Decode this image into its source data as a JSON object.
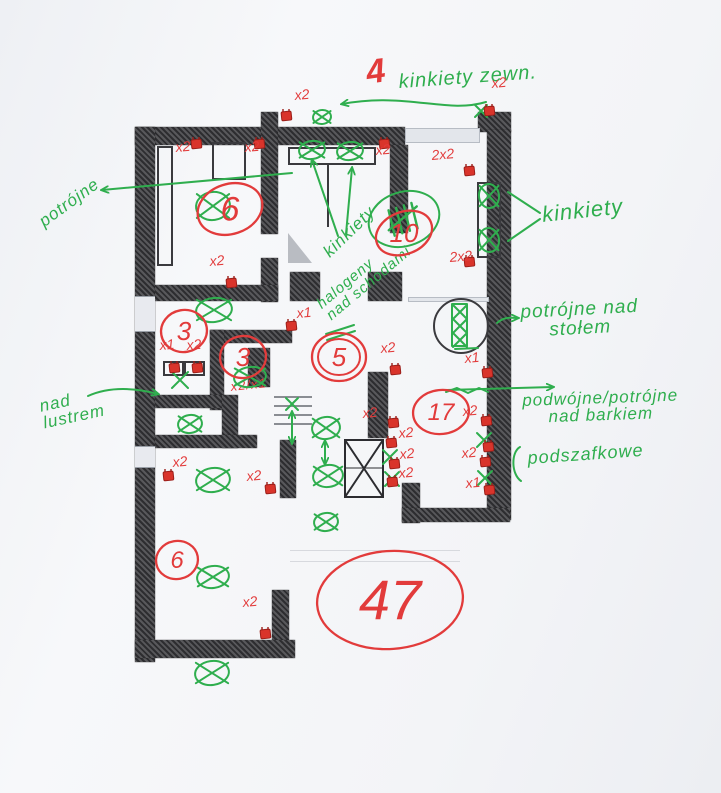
{
  "page": {
    "kind": "scanned hand-annotated electrical floor plan",
    "language": "pl"
  },
  "colors": {
    "green": "#2fae4e",
    "red": "#e23b3b",
    "wall": "#3c3c40",
    "paper": "#f5f6f8"
  },
  "labels": [
    {
      "name": "count-4-exterior",
      "lines": [
        "4"
      ],
      "color": "red",
      "x": 364,
      "y": 56,
      "size": 34,
      "rot": -8,
      "bold": true
    },
    {
      "name": "kinkiety-zewn-label",
      "lines": [
        "kinkiety zewn."
      ],
      "color": "green",
      "x": 398,
      "y": 72,
      "size": 20,
      "rot": -4
    },
    {
      "name": "potrojne-label",
      "lines": [
        "potrójne"
      ],
      "color": "green",
      "x": 36,
      "y": 216,
      "size": 17,
      "rot": -36
    },
    {
      "name": "kinkiety-mid-label",
      "lines": [
        "kinkiety"
      ],
      "color": "green",
      "x": 320,
      "y": 248,
      "size": 17,
      "rot": -44
    },
    {
      "name": "kinkiety-right-label",
      "lines": [
        "kinkiety"
      ],
      "color": "green",
      "x": 541,
      "y": 204,
      "size": 22,
      "rot": -6
    },
    {
      "name": "nad-lustrem-label",
      "lines": [
        "nad",
        "lustrem"
      ],
      "color": "green",
      "x": 38,
      "y": 398,
      "size": 17,
      "rot": -12
    },
    {
      "name": "halogeny-label",
      "lines": [
        "halogeny",
        "nad schodami"
      ],
      "color": "green",
      "x": 314,
      "y": 300,
      "size": 15,
      "rot": -40
    },
    {
      "name": "nad-stolem-label",
      "lines": [
        "potrójne nad",
        "stołem"
      ],
      "color": "green",
      "x": 520,
      "y": 303,
      "size": 19,
      "rot": -3,
      "center": true
    },
    {
      "name": "nad-barkiem-label",
      "lines": [
        "podwójne/potrójne",
        "nad barkiem"
      ],
      "color": "green",
      "x": 522,
      "y": 392,
      "size": 17,
      "rot": -2,
      "center": true
    },
    {
      "name": "podszafkowe-label",
      "lines": [
        "podszafkowe"
      ],
      "color": "green",
      "x": 527,
      "y": 449,
      "size": 18,
      "rot": -4
    },
    {
      "name": "socket-note-x2x1",
      "lines": [
        "x2/x1"
      ],
      "color": "red",
      "x": 230,
      "y": 380,
      "size": 13,
      "rot": -6
    }
  ],
  "counts": [
    {
      "value": "6",
      "cx": 230,
      "cy": 209,
      "rx": 33,
      "ry": 25,
      "rot": -18,
      "size": 34
    },
    {
      "value": "10",
      "cx": 404,
      "cy": 233,
      "rx": 29,
      "ry": 21,
      "rot": -22,
      "size": 26
    },
    {
      "value": "3",
      "cx": 184,
      "cy": 331,
      "rx": 23,
      "ry": 21,
      "rot": -10,
      "size": 26
    },
    {
      "value": "3",
      "cx": 243,
      "cy": 357,
      "rx": 23,
      "ry": 21,
      "rot": -8,
      "size": 26
    },
    {
      "value": "5",
      "cx": 339,
      "cy": 357,
      "rx": 27,
      "ry": 24,
      "rot": 0,
      "size": 26,
      "double": true
    },
    {
      "value": "17",
      "cx": 441,
      "cy": 412,
      "rx": 28,
      "ry": 22,
      "rot": -6,
      "size": 24
    },
    {
      "value": "6",
      "cx": 177,
      "cy": 560,
      "rx": 21,
      "ry": 19,
      "rot": -10,
      "size": 24
    },
    {
      "value": "47",
      "cx": 390,
      "cy": 600,
      "rx": 73,
      "ry": 49,
      "rot": -4,
      "size": 56
    }
  ],
  "tally": {
    "cx": 404,
    "cy": 219,
    "rx": 36,
    "ry": 27,
    "rot": -18,
    "marks": 5
  },
  "lamps": [
    {
      "cx": 322,
      "cy": 117,
      "rx": 9,
      "ry": 7
    },
    {
      "cx": 312,
      "cy": 150,
      "rx": 13,
      "ry": 9
    },
    {
      "cx": 350,
      "cy": 151,
      "rx": 13,
      "ry": 9
    },
    {
      "cx": 214,
      "cy": 310,
      "rx": 18,
      "ry": 12
    },
    {
      "cx": 489,
      "cy": 196,
      "rx": 10,
      "ry": 12
    },
    {
      "cx": 489,
      "cy": 240,
      "rx": 10,
      "ry": 12
    },
    {
      "cx": 250,
      "cy": 377,
      "rx": 16,
      "ry": 10
    },
    {
      "cx": 190,
      "cy": 424,
      "rx": 12,
      "ry": 9
    },
    {
      "cx": 213,
      "cy": 480,
      "rx": 17,
      "ry": 12
    },
    {
      "cx": 326,
      "cy": 428,
      "rx": 14,
      "ry": 11
    },
    {
      "cx": 328,
      "cy": 476,
      "rx": 15,
      "ry": 11
    },
    {
      "cx": 326,
      "cy": 522,
      "rx": 12,
      "ry": 9
    },
    {
      "cx": 213,
      "cy": 577,
      "rx": 16,
      "ry": 11
    },
    {
      "cx": 212,
      "cy": 673,
      "rx": 17,
      "ry": 12
    },
    {
      "cx": 213,
      "cy": 206,
      "rx": 17,
      "ry": 14
    }
  ],
  "x_marks": [
    {
      "x": 180,
      "y": 380,
      "s": 8
    },
    {
      "x": 390,
      "y": 457,
      "s": 7
    },
    {
      "x": 392,
      "y": 479,
      "s": 7
    },
    {
      "x": 484,
      "y": 440,
      "s": 7
    },
    {
      "x": 485,
      "y": 478,
      "s": 7
    },
    {
      "x": 460,
      "y": 312,
      "s": 7
    },
    {
      "x": 460,
      "y": 326,
      "s": 7
    },
    {
      "x": 460,
      "y": 340,
      "s": 7
    },
    {
      "x": 292,
      "y": 404,
      "s": 6
    },
    {
      "x": 481,
      "y": 111,
      "s": 6
    }
  ],
  "sockets": [
    {
      "x": 281,
      "y": 112,
      "label": "x2",
      "lx": 295,
      "ly": 100
    },
    {
      "x": 484,
      "y": 107,
      "label": "x2",
      "lx": 492,
      "ly": 88
    },
    {
      "x": 191,
      "y": 140,
      "label": "x2",
      "lx": 176,
      "ly": 152
    },
    {
      "x": 254,
      "y": 140,
      "label": "x2",
      "lx": 245,
      "ly": 152
    },
    {
      "x": 379,
      "y": 140,
      "label": "x2",
      "lx": 376,
      "ly": 155
    },
    {
      "x": 464,
      "y": 167,
      "label": "2x2",
      "lx": 432,
      "ly": 160
    },
    {
      "x": 464,
      "y": 258,
      "label": "2x2",
      "lx": 450,
      "ly": 262
    },
    {
      "x": 226,
      "y": 279,
      "label": "x2",
      "lx": 210,
      "ly": 266
    },
    {
      "x": 286,
      "y": 322,
      "label": "x1",
      "lx": 297,
      "ly": 318
    },
    {
      "x": 169,
      "y": 364,
      "label": "x1",
      "lx": 160,
      "ly": 350
    },
    {
      "x": 192,
      "y": 364,
      "label": "x2",
      "lx": 187,
      "ly": 350
    },
    {
      "x": 390,
      "y": 366,
      "label": "x2",
      "lx": 381,
      "ly": 353
    },
    {
      "x": 482,
      "y": 369,
      "label": "x1",
      "lx": 465,
      "ly": 363
    },
    {
      "x": 388,
      "y": 419,
      "label": "x2",
      "lx": 363,
      "ly": 418
    },
    {
      "x": 386,
      "y": 439,
      "label": "x2",
      "lx": 399,
      "ly": 438
    },
    {
      "x": 389,
      "y": 460,
      "label": "x2",
      "lx": 400,
      "ly": 459
    },
    {
      "x": 387,
      "y": 478,
      "label": "x2",
      "lx": 399,
      "ly": 478
    },
    {
      "x": 481,
      "y": 417,
      "label": "x2",
      "lx": 463,
      "ly": 416
    },
    {
      "x": 483,
      "y": 443,
      "label": ""
    },
    {
      "x": 480,
      "y": 458,
      "label": "x2",
      "lx": 462,
      "ly": 458
    },
    {
      "x": 484,
      "y": 486,
      "label": "x1",
      "lx": 466,
      "ly": 488
    },
    {
      "x": 163,
      "y": 472,
      "label": "x2",
      "lx": 173,
      "ly": 467
    },
    {
      "x": 265,
      "y": 485,
      "label": "x2",
      "lx": 247,
      "ly": 481
    },
    {
      "x": 260,
      "y": 630,
      "label": "x2",
      "lx": 243,
      "ly": 607
    }
  ],
  "arrows": [
    {
      "d": "M 486,102 C 446,114 408,92 342,104",
      "head": "end"
    },
    {
      "d": "M 292,173 L 102,190",
      "head": "end"
    },
    {
      "d": "M 338,236 L 312,160",
      "head": "end"
    },
    {
      "d": "M 346,234 L 352,168",
      "head": "end"
    },
    {
      "d": "M 540,213 L 508,192",
      "head": "none"
    },
    {
      "d": "M 540,219 L 508,241",
      "head": "none"
    },
    {
      "d": "M 88,396 C 110,386 136,388 158,394",
      "head": "end"
    },
    {
      "d": "M 497,323 C 505,316 512,318 518,318",
      "head": "end"
    },
    {
      "d": "M 447,390 L 553,387",
      "head": "end"
    },
    {
      "d": "M 325,441 L 325,464",
      "head": "both"
    },
    {
      "d": "M 292,412 L 292,443",
      "head": "both"
    },
    {
      "d": "M 520,447 C 511,452 511,474 521,481",
      "head": "none"
    },
    {
      "d": "M 326,334 L 354,325",
      "head": "none"
    },
    {
      "d": "M 327,340 L 355,331",
      "head": "none"
    },
    {
      "d": "M 455,349 L 478,348",
      "head": "none"
    },
    {
      "d": "M 446,392 L 457,388 L 468,393 L 479,388 L 488,392",
      "head": "none"
    },
    {
      "d": "M 452,304 L 467,304 L 467,346 L 452,346 Z",
      "head": "none"
    }
  ]
}
